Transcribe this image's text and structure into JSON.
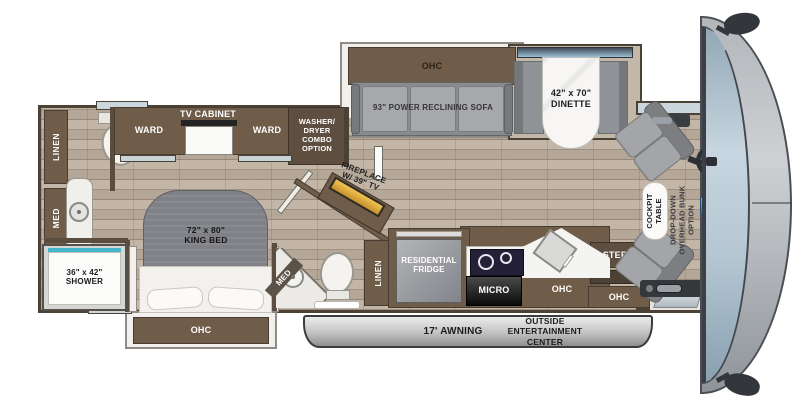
{
  "labels": {
    "linen_rear": "LINEN",
    "med_rear": "MED",
    "shower": "36\" x 42\"\nSHOWER",
    "ward_left": "WARD",
    "tv_cabinet": "TV CABINET",
    "ward_right": "WARD",
    "washer_dryer": "WASHER/\nDRYER\nCOMBO\nOPTION",
    "king_bed": "72\" x 80\"\nKING BED",
    "bed_ohc": "OHC",
    "med_mid": "MED",
    "linen_mid": "LINEN",
    "fireplace": "FIREPLACE\nW/ 39\" TV",
    "sofa_ohc": "OHC",
    "sofa": "93\" POWER RECLINING SOFA",
    "dinette": "42\" x 70\"\nDINETTE",
    "fridge": "RESIDENTIAL\nFRIDGE",
    "micro": "MICRO",
    "kitchen_ohc": "OHC",
    "steps": "STEPS",
    "entry_ohc": "OHC",
    "cockpit_table": "COCKPIT\nTABLE",
    "bunk_option": "DROP-DOWN\nOVERHEAD BUNK\nOPTION",
    "awning": "17' AWNING",
    "outside_ent": "OUTSIDE\nENTERTAINMENT\nCENTER"
  },
  "colors": {
    "cabinet_brown": "#6F5C49",
    "floor_wood": "#BEB0A0",
    "slide_frame_white": "#F2F0EC",
    "furniture_gray": "#A3A5A8",
    "shower_accent_teal": "#45B7C8",
    "fireplace_gold": "#E3AC3C",
    "awning_gray": "#C6C6C6",
    "windshield_blue": "#B4C6D2"
  }
}
